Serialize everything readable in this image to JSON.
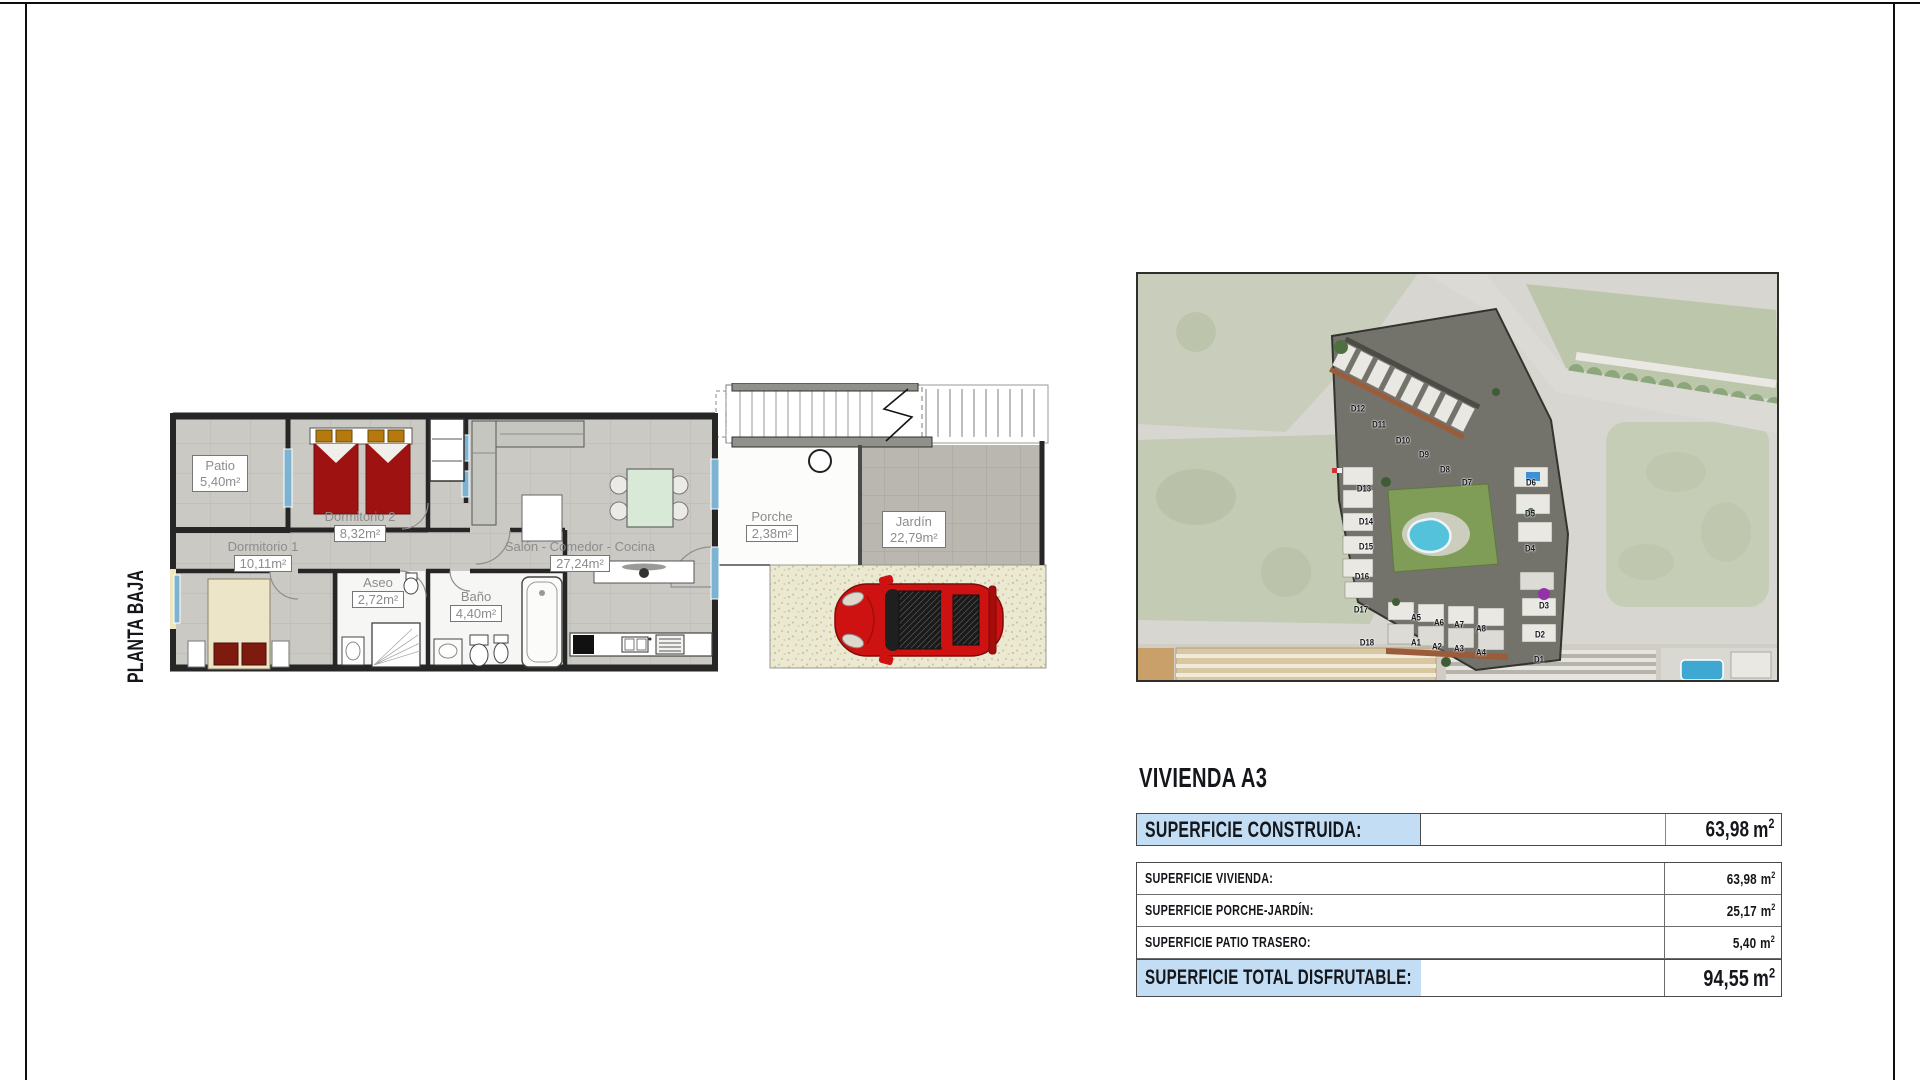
{
  "plan": {
    "floor_label": "PLANTA BAJA",
    "rooms": {
      "patio": {
        "name": "Patio",
        "area": "5,40m²"
      },
      "dormitorio2": {
        "name": "Dormitorio 2",
        "area": "8,32m²"
      },
      "dormitorio1": {
        "name": "Dormitorio 1",
        "area": "10,11m²"
      },
      "aseo": {
        "name": "Aseo",
        "area": "2,72m²"
      },
      "bano": {
        "name": "Baño",
        "area": "4,40m²"
      },
      "salon": {
        "name": "Salón - Comedor - Cocina",
        "area": "27,24m²"
      },
      "porche": {
        "name": "Porche",
        "area": "2,38m²"
      },
      "jardin": {
        "name": "Jardín",
        "area": "22,79m²"
      }
    }
  },
  "map": {
    "units": [
      {
        "label": "D12",
        "x": 34.5,
        "y": 33.4
      },
      {
        "label": "D11",
        "x": 37.8,
        "y": 37.3
      },
      {
        "label": "D10",
        "x": 41.5,
        "y": 41.2
      },
      {
        "label": "D9",
        "x": 44.8,
        "y": 44.6
      },
      {
        "label": "D8",
        "x": 48.1,
        "y": 48.3
      },
      {
        "label": "D7",
        "x": 51.5,
        "y": 51.5
      },
      {
        "label": "D6",
        "x": 61.4,
        "y": 51.5
      },
      {
        "label": "D5",
        "x": 61.3,
        "y": 59.0
      },
      {
        "label": "D4",
        "x": 61.3,
        "y": 67.6
      },
      {
        "label": "D3",
        "x": 63.5,
        "y": 81.5
      },
      {
        "label": "D2",
        "x": 62.8,
        "y": 88.5
      },
      {
        "label": "D1",
        "x": 62.7,
        "y": 94.6
      },
      {
        "label": "D13",
        "x": 35.5,
        "y": 52.9
      },
      {
        "label": "D14",
        "x": 35.8,
        "y": 61.0
      },
      {
        "label": "D15",
        "x": 35.8,
        "y": 67.1
      },
      {
        "label": "D16",
        "x": 35.1,
        "y": 74.4
      },
      {
        "label": "D17",
        "x": 35.0,
        "y": 82.4
      },
      {
        "label": "D18",
        "x": 35.9,
        "y": 90.5
      },
      {
        "label": "A5",
        "x": 43.5,
        "y": 84.4
      },
      {
        "label": "A6",
        "x": 47.1,
        "y": 85.6
      },
      {
        "label": "A7",
        "x": 50.2,
        "y": 86.1
      },
      {
        "label": "A8",
        "x": 53.7,
        "y": 87.1
      },
      {
        "label": "A1",
        "x": 43.5,
        "y": 90.5
      },
      {
        "label": "A2",
        "x": 46.8,
        "y": 91.5
      },
      {
        "label": "A3",
        "x": 50.2,
        "y": 92.0
      },
      {
        "label": "A4",
        "x": 53.7,
        "y": 92.9
      }
    ]
  },
  "info": {
    "title": "VIVIENDA A3",
    "highlight_color": "#c3def4",
    "header": {
      "label": "SUPERFICIE CONSTRUIDA:",
      "value": "63,98",
      "unit": "m",
      "sup": "2"
    },
    "rows": [
      {
        "label": "SUPERFICIE VIVIENDA:",
        "value": "63,98",
        "unit": "m",
        "sup": "2"
      },
      {
        "label": "SUPERFICIE PORCHE-JARDÍN:",
        "value": "25,17",
        "unit": "m",
        "sup": "2"
      },
      {
        "label": "SUPERFICIE PATIO TRASERO:",
        "value": "5,40",
        "unit": "m",
        "sup": "2"
      }
    ],
    "total": {
      "label": "SUPERFICIE TOTAL DISFRUTABLE:",
      "value": "94,55",
      "unit": "m",
      "sup": "2"
    }
  }
}
